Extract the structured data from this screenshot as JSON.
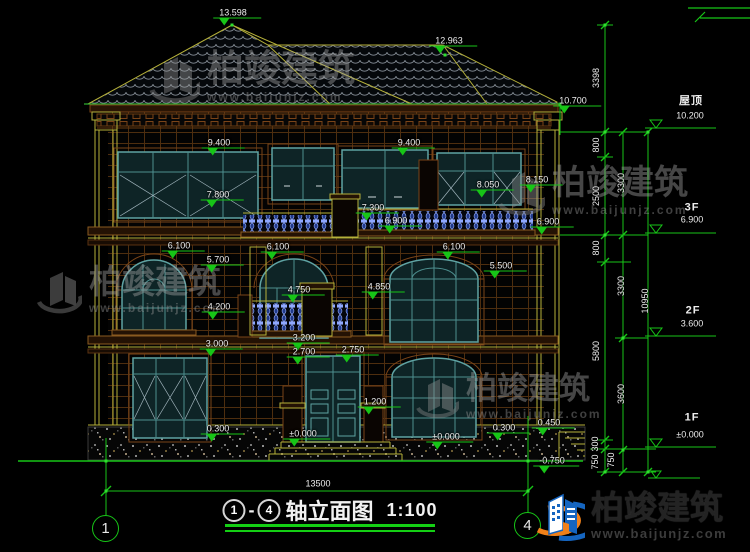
{
  "drawing_title_block": {
    "axis_from": "1",
    "separator": "-",
    "axis_to": "4",
    "title": "轴立面图",
    "scale": "1:100"
  },
  "axes": {
    "left_bubble": "1",
    "right_bubble": "4"
  },
  "watermark": {
    "brand": "柏竣建筑",
    "url": "www.baijunjz.com"
  },
  "footer_logo": {
    "brand": "柏竣建筑",
    "url": "www.baijunjz.com"
  },
  "colors": {
    "dim_green": "#17c517",
    "structure_yellow": "#b6b13a",
    "window_teal": "#5fa3a3",
    "band_brown": "#7a4418",
    "baluster_blue": "#8fa8ff",
    "roof_tile_grey": "#858d96",
    "logo_blue": "#1565c0",
    "logo_orange": "#f08019",
    "text_white": "#ededed"
  },
  "levels": [
    {
      "name": "屋顶",
      "elevation": "10.200"
    },
    {
      "name": "3F",
      "elevation": "6.900"
    },
    {
      "name": "2F",
      "elevation": "3.600"
    },
    {
      "name": "1F",
      "elevation": "±0.000"
    }
  ],
  "dim_chains": {
    "chain_a": [
      "3398",
      "800",
      "2500",
      "800",
      "5800",
      "300",
      "750"
    ],
    "chain_b": [
      "3300",
      "3300",
      "3600",
      "750"
    ],
    "total": "10950",
    "overall_width": "13500"
  },
  "annotations": {
    "roof_spots": [
      {
        "t": "13.598",
        "x": 233,
        "y": 13,
        "m": 1
      },
      {
        "t": "12.963",
        "x": 449,
        "y": 41,
        "m": 1
      },
      {
        "t": "10.700",
        "x": 573,
        "y": 101,
        "m": 1
      }
    ],
    "f3_spots": [
      {
        "t": "9.400",
        "x": 219,
        "y": 143,
        "m": 1
      },
      {
        "t": "9.400",
        "x": 409,
        "y": 143,
        "m": 1
      },
      {
        "t": "7.800",
        "x": 218,
        "y": 195,
        "m": 1
      },
      {
        "t": "8.050",
        "x": 488,
        "y": 185,
        "m": 1
      },
      {
        "t": "8.150",
        "x": 537,
        "y": 180,
        "m": 1
      },
      {
        "t": "7.300",
        "x": 373,
        "y": 208,
        "m": 1
      },
      {
        "t": "6.900",
        "x": 396,
        "y": 221,
        "m": 1
      },
      {
        "t": "6.900",
        "x": 548,
        "y": 222,
        "m": 1
      }
    ],
    "f2_spots": [
      {
        "t": "6.100",
        "x": 179,
        "y": 246,
        "m": 1
      },
      {
        "t": "6.100",
        "x": 278,
        "y": 247,
        "m": 1
      },
      {
        "t": "6.100",
        "x": 454,
        "y": 247,
        "m": 1
      },
      {
        "t": "5.700",
        "x": 218,
        "y": 260,
        "m": 1
      },
      {
        "t": "5.500",
        "x": 501,
        "y": 266,
        "m": 1
      },
      {
        "t": "4.750",
        "x": 299,
        "y": 290,
        "m": 1
      },
      {
        "t": "4.850",
        "x": 379,
        "y": 287,
        "m": 1
      },
      {
        "t": "4.200",
        "x": 219,
        "y": 307,
        "m": 1
      },
      {
        "t": "3.000",
        "x": 217,
        "y": 344,
        "m": 1
      },
      {
        "t": "3.200",
        "x": 304,
        "y": 338,
        "m": 1
      },
      {
        "t": "2.700",
        "x": 304,
        "y": 352,
        "m": 1
      },
      {
        "t": "2.750",
        "x": 353,
        "y": 350,
        "m": 1
      }
    ],
    "f1_spots": [
      {
        "t": "1.200",
        "x": 375,
        "y": 402,
        "m": 1
      },
      {
        "t": "0.300",
        "x": 218,
        "y": 429,
        "m": 1
      },
      {
        "t": "±0.000",
        "x": 303,
        "y": 434,
        "m": 1
      },
      {
        "t": "±0.000",
        "x": 446,
        "y": 437,
        "m": 1
      },
      {
        "t": "0.300",
        "x": 504,
        "y": 428,
        "m": 1
      },
      {
        "t": "0.450",
        "x": 549,
        "y": 423,
        "m": 1
      },
      {
        "t": "-0.750",
        "x": 552,
        "y": 461,
        "m": 1
      }
    ],
    "overall_width_label": [
      {
        "t": "13500",
        "x": 318,
        "y": 484
      }
    ],
    "chain_a_labels": [
      {
        "t": "3398",
        "x": 596,
        "y": 78,
        "r": 1
      },
      {
        "t": "800",
        "x": 596,
        "y": 145,
        "r": 1
      },
      {
        "t": "2500",
        "x": 596,
        "y": 196,
        "r": 1
      },
      {
        "t": "800",
        "x": 596,
        "y": 248,
        "r": 1
      },
      {
        "t": "5800",
        "x": 596,
        "y": 351,
        "r": 1
      },
      {
        "t": "300",
        "x": 595,
        "y": 444,
        "r": 1
      },
      {
        "t": "750",
        "x": 595,
        "y": 462,
        "r": 1
      }
    ],
    "chain_b_labels": [
      {
        "t": "3300",
        "x": 621,
        "y": 183,
        "r": 1
      },
      {
        "t": "3300",
        "x": 621,
        "y": 286,
        "r": 1
      },
      {
        "t": "3600",
        "x": 621,
        "y": 394,
        "r": 1
      },
      {
        "t": "750",
        "x": 611,
        "y": 460,
        "r": 1
      }
    ],
    "chain_total_label": [
      {
        "t": "10950",
        "x": 645,
        "y": 301,
        "r": 1
      }
    ],
    "floor_level_labels": [
      {
        "t": "屋顶",
        "x": 691,
        "y": 101,
        "c": "flr"
      },
      {
        "t": "10.200",
        "x": 690,
        "y": 116
      },
      {
        "t": "3F",
        "x": 692,
        "y": 208,
        "c": "flr"
      },
      {
        "t": "6.900",
        "x": 692,
        "y": 220
      },
      {
        "t": "2F",
        "x": 693,
        "y": 311,
        "c": "flr"
      },
      {
        "t": "3.600",
        "x": 692,
        "y": 324
      },
      {
        "t": "1F",
        "x": 692,
        "y": 418,
        "c": "flr"
      },
      {
        "t": "±0.000",
        "x": 690,
        "y": 435
      }
    ]
  }
}
